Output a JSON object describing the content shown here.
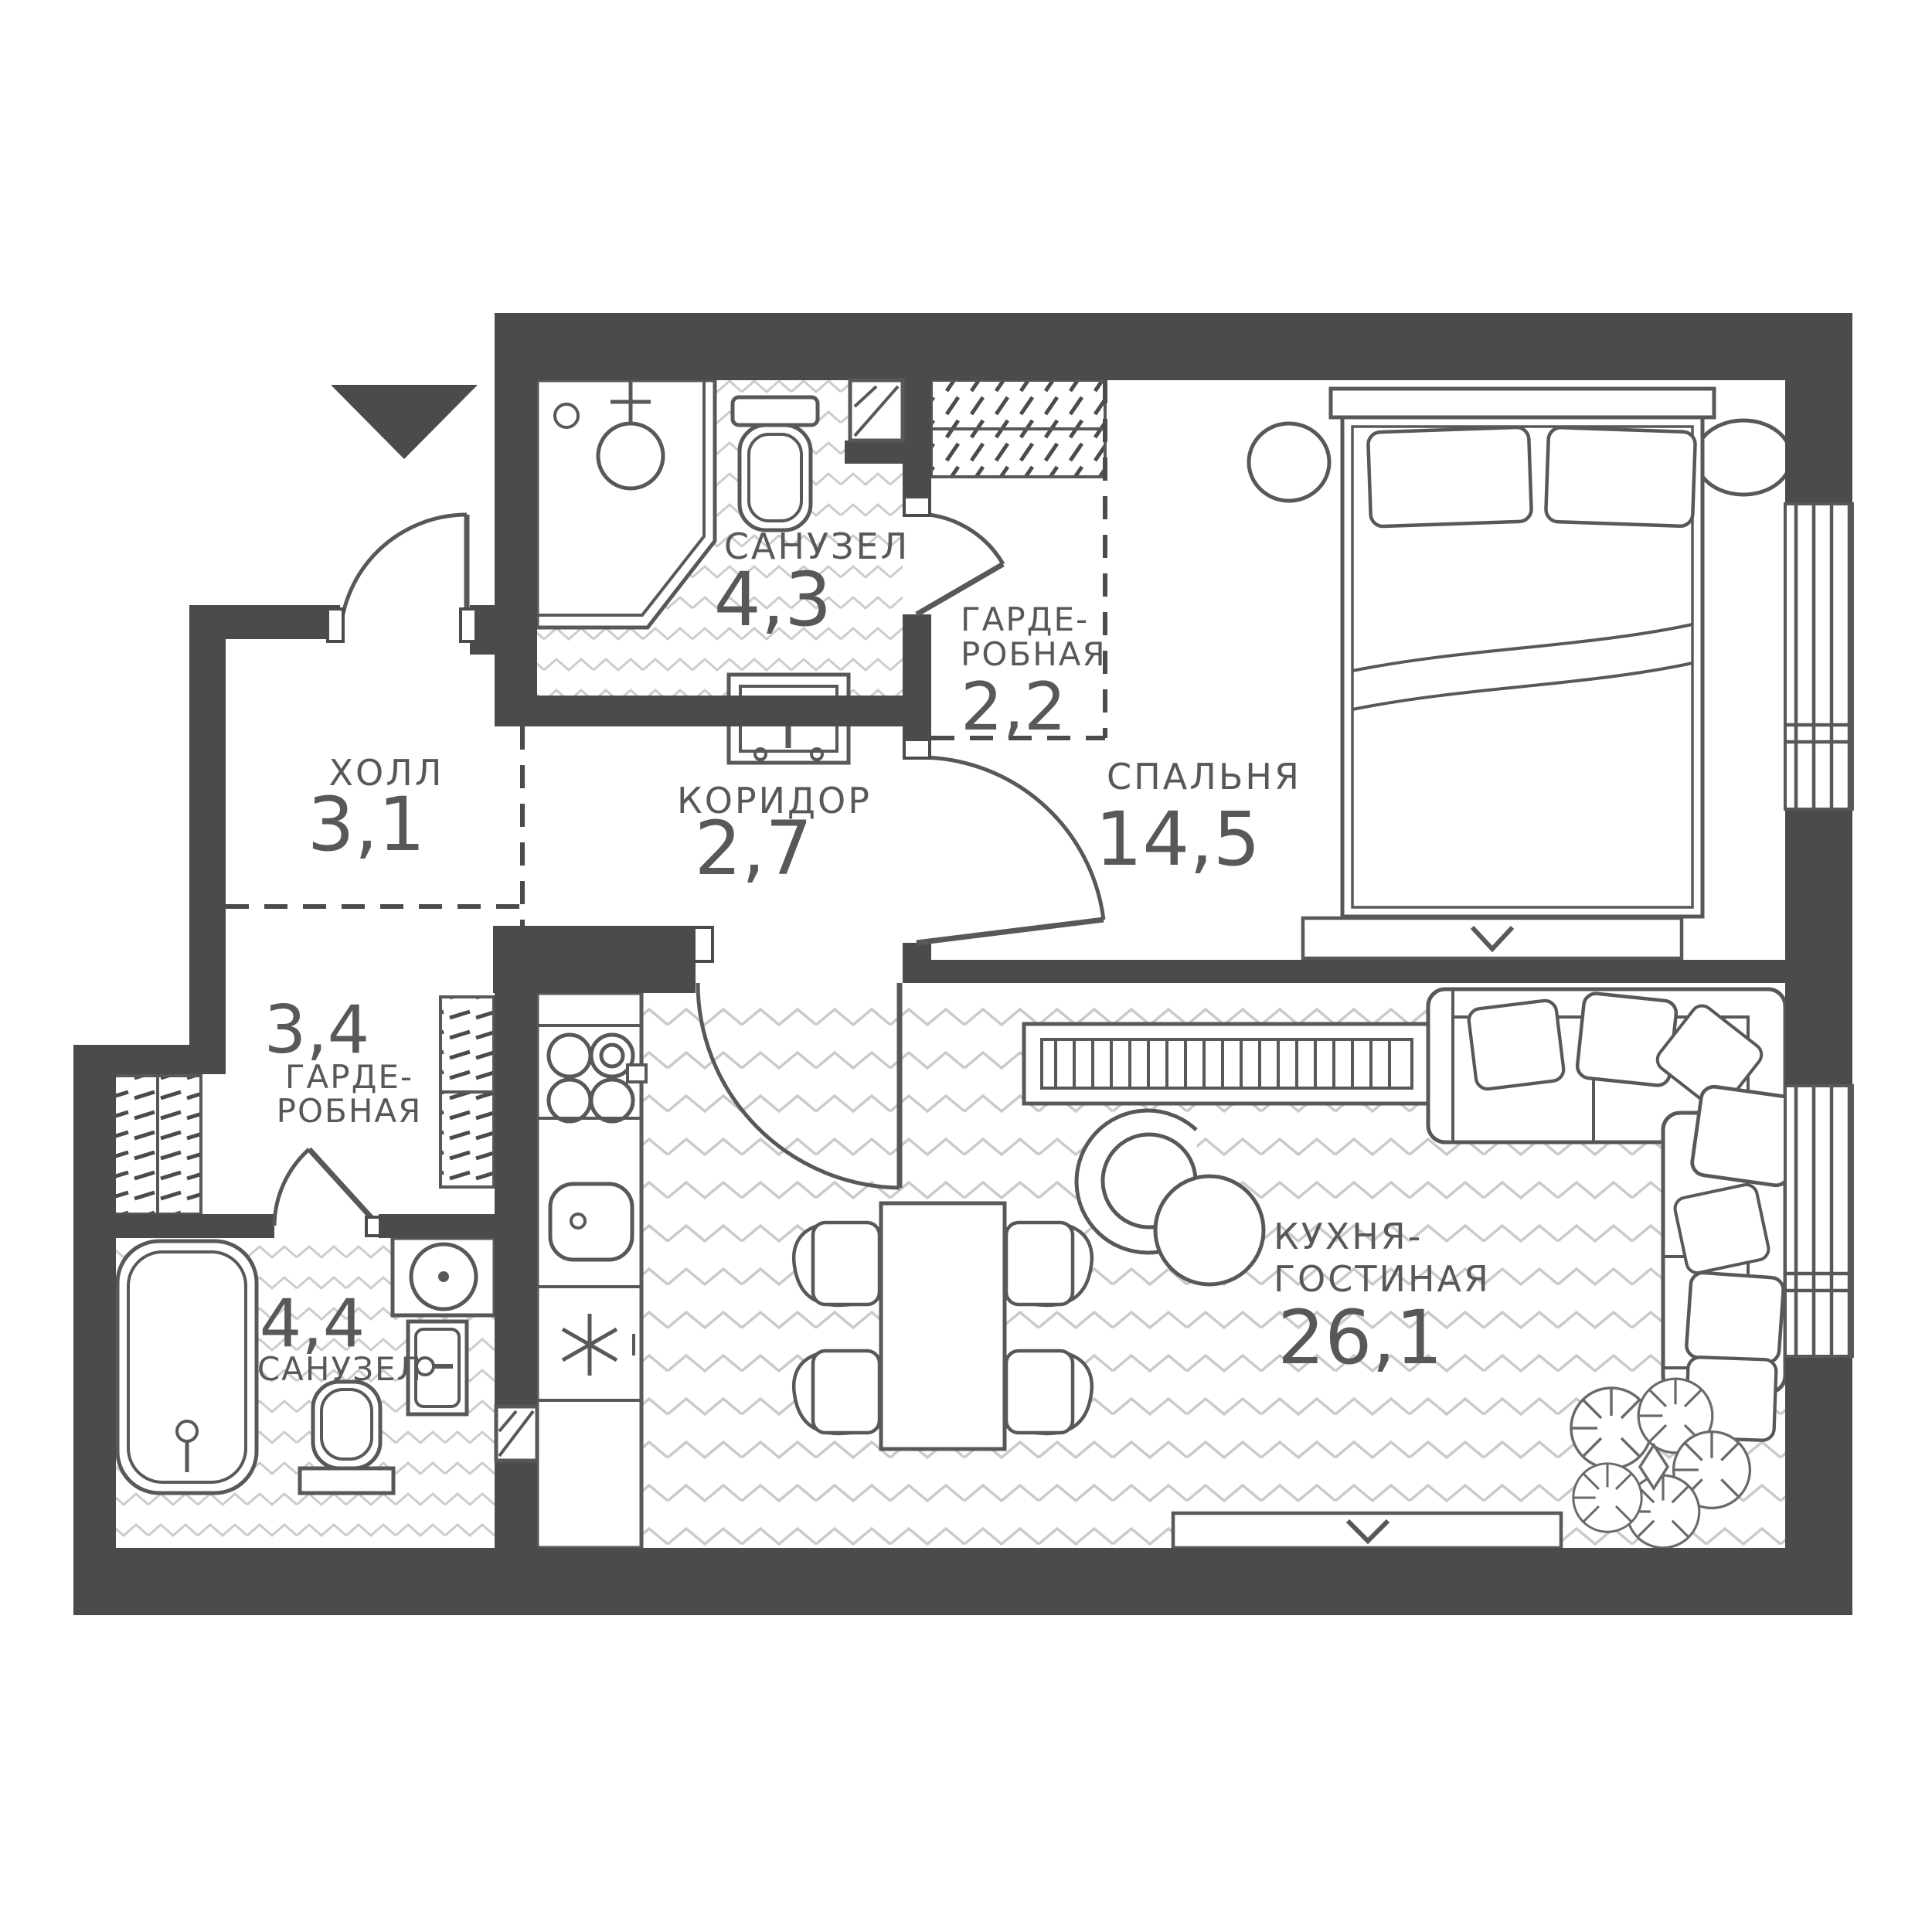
{
  "plan": {
    "type": "apartment-floor-plan",
    "colors": {
      "wall": "#4b4b4d",
      "fixture_line": "#58585a",
      "floor_pattern": "#c9cacb",
      "text": "#58585a",
      "background": "#ffffff"
    },
    "symbols": {
      "entrance_arrow": "filled triangle pointing down",
      "window_sash_chevron": "∨",
      "fridge_snowflake": "six-arm asterisk",
      "vent_shaft": "white square with diagonal"
    }
  },
  "rooms": [
    {
      "name": "ХОЛЛ",
      "area": "3,1"
    },
    {
      "name": "САНУЗЕЛ",
      "area": "4,3"
    },
    {
      "name_line1": "ГАРДЕ-",
      "name_line2": "РОБНАЯ",
      "area": "2,2"
    },
    {
      "name": "КОРИДОР",
      "area": "2,7"
    },
    {
      "name": "СПАЛЬНЯ",
      "area": "14,5"
    },
    {
      "area": "3,4",
      "name_line1": "ГАРДЕ-",
      "name_line2": "РОБНАЯ"
    },
    {
      "area": "4,4",
      "name": "САНУЗЕЛ"
    },
    {
      "name_line1": "КУХНЯ-",
      "name_line2": "ГОСТИНАЯ",
      "area": "26,1"
    }
  ]
}
